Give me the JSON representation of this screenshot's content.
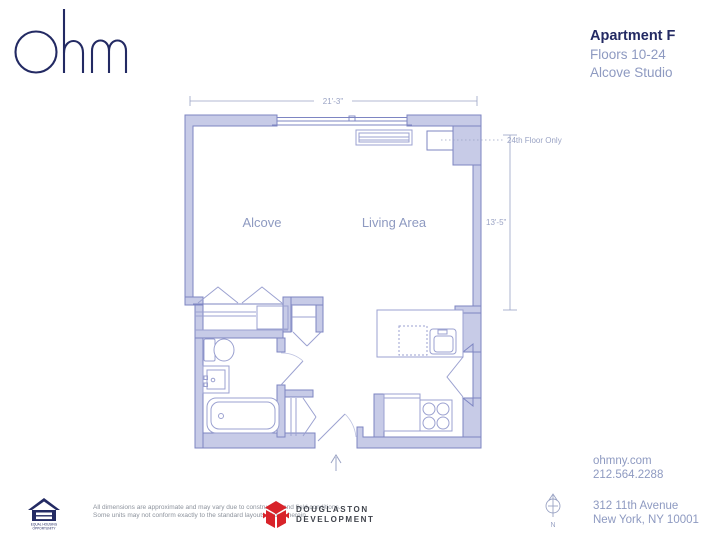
{
  "brand": {
    "logo": "ohm"
  },
  "header": {
    "apartment": "Apartment F",
    "floors": "Floors 10-24",
    "unit_type": "Alcove Studio"
  },
  "floor_plan": {
    "width_dimension": "21'-3\"",
    "height_dimension": "13'-5\"",
    "callout": "24th Floor Only",
    "rooms": [
      {
        "name": "Alcove"
      },
      {
        "name": "Living Area"
      }
    ],
    "compass_label": "N"
  },
  "contact": {
    "website": "ohmny.com",
    "phone": "212.564.2288",
    "address_line1": "312 11th Avenue",
    "address_line2": "New York, NY 10001"
  },
  "footer": {
    "disclaimer_line1": "All dimensions are approximate and may vary due to construction and field conditions.",
    "disclaimer_line2": "Some units may not conform exactly to the standard layouts shown herein.",
    "equal_housing_line1": "EQUAL HOUSING",
    "equal_housing_line2": "OPPORTUNITY",
    "developer_line1": "DOUGLASTON",
    "developer_line2": "DEVELOPMENT"
  },
  "colors": {
    "navy": "#232a63",
    "light_blue_text": "#8e9ac1",
    "wall_fill": "#c7cbe7",
    "wall_stroke": "#7d85c2",
    "fixture_stroke": "#9ba1d0",
    "red_accent": "#d8232a"
  }
}
